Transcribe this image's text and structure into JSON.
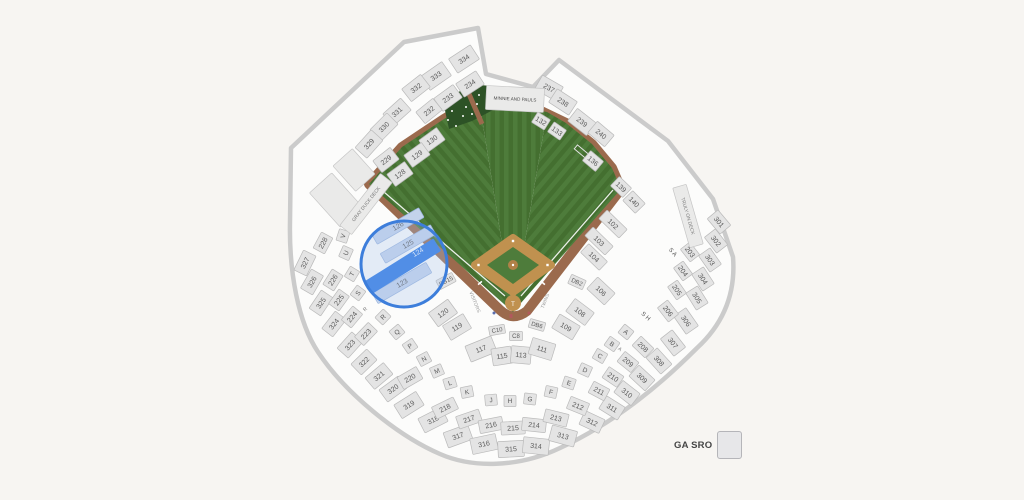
{
  "legend": {
    "label": "GA SRO"
  },
  "map": {
    "highlight": {
      "selected_section": "124",
      "circled_sections": [
        "123",
        "124",
        "125",
        "126"
      ]
    },
    "colors": {
      "background": "#f7f5f2",
      "bowl": "#fcfcfb",
      "wall": "#cbcbcb",
      "section_fill": "#e4e4e4",
      "section_stroke": "#bababa",
      "label": "#5a5a5a",
      "grass_light": "#4e7c3b",
      "grass_dark": "#446f30",
      "track": "#9b6a4d",
      "dirt": "#c0914f",
      "mound": "#b08148",
      "batters_eye": "#2d5226",
      "tint_fill": "#c3d3ec",
      "tint_stroke": "#9ab4dd",
      "selected_fill": "#2b78e4",
      "selected_text": "#eaf2fd",
      "highlight_ring": "#3d7edb",
      "highlight_fill": "#aac4ea"
    },
    "sections": [
      {
        "l": "",
        "x": 336,
        "y": 200,
        "r": -42,
        "w": 30,
        "h": 46,
        "t": "deck"
      },
      {
        "l": "",
        "x": 354,
        "y": 170,
        "r": -42,
        "w": 26,
        "h": 34,
        "t": "deck"
      },
      {
        "l": "334",
        "x": 464,
        "y": 59,
        "r": -33,
        "w": 26,
        "h": 17
      },
      {
        "l": "333",
        "x": 436,
        "y": 76,
        "r": -35,
        "w": 26,
        "h": 17
      },
      {
        "l": "332",
        "x": 416,
        "y": 88,
        "r": -38,
        "w": 24,
        "h": 16
      },
      {
        "l": "331",
        "x": 397,
        "y": 112,
        "r": -42,
        "w": 24,
        "h": 16
      },
      {
        "l": "330",
        "x": 384,
        "y": 127,
        "r": -45,
        "w": 24,
        "h": 16
      },
      {
        "l": "329",
        "x": 369,
        "y": 144,
        "r": -48,
        "w": 24,
        "h": 16
      },
      {
        "l": "327",
        "x": 305,
        "y": 263,
        "r": -64,
        "w": 22,
        "h": 14
      },
      {
        "l": "326",
        "x": 312,
        "y": 282,
        "r": -60,
        "w": 22,
        "h": 14
      },
      {
        "l": "325",
        "x": 321,
        "y": 303,
        "r": -56,
        "w": 22,
        "h": 14
      },
      {
        "l": "324",
        "x": 334,
        "y": 324,
        "r": -52,
        "w": 22,
        "h": 14
      },
      {
        "l": "323",
        "x": 350,
        "y": 345,
        "r": -48,
        "w": 22,
        "h": 15
      },
      {
        "l": "322",
        "x": 364,
        "y": 362,
        "r": -44,
        "w": 22,
        "h": 15
      },
      {
        "l": "321",
        "x": 379,
        "y": 376,
        "r": -40,
        "w": 24,
        "h": 15
      },
      {
        "l": "320",
        "x": 393,
        "y": 389,
        "r": -36,
        "w": 24,
        "h": 15
      },
      {
        "l": "319",
        "x": 409,
        "y": 405,
        "r": -32,
        "w": 26,
        "h": 16
      },
      {
        "l": "318",
        "x": 433,
        "y": 420,
        "r": -27,
        "w": 26,
        "h": 16
      },
      {
        "l": "317",
        "x": 458,
        "y": 436,
        "r": -20,
        "w": 26,
        "h": 16
      },
      {
        "l": "316",
        "x": 484,
        "y": 444,
        "r": -12,
        "w": 26,
        "h": 16
      },
      {
        "l": "315",
        "x": 511,
        "y": 449,
        "r": -3,
        "w": 26,
        "h": 16
      },
      {
        "l": "314",
        "x": 536,
        "y": 446,
        "r": 6,
        "w": 26,
        "h": 16
      },
      {
        "l": "313",
        "x": 563,
        "y": 436,
        "r": 15,
        "w": 26,
        "h": 16
      },
      {
        "l": "312",
        "x": 592,
        "y": 422,
        "r": 25,
        "w": 22,
        "h": 15
      },
      {
        "l": "311",
        "x": 612,
        "y": 408,
        "r": 32,
        "w": 22,
        "h": 15
      },
      {
        "l": "310",
        "x": 627,
        "y": 393,
        "r": 38,
        "w": 22,
        "h": 15
      },
      {
        "l": "309",
        "x": 642,
        "y": 378,
        "r": 43,
        "w": 22,
        "h": 15
      },
      {
        "l": "308",
        "x": 659,
        "y": 361,
        "r": 48,
        "w": 22,
        "h": 15
      },
      {
        "l": "307",
        "x": 673,
        "y": 343,
        "r": 52,
        "w": 22,
        "h": 15
      },
      {
        "l": "306",
        "x": 686,
        "y": 321,
        "r": 55,
        "w": 22,
        "h": 15
      },
      {
        "l": "305",
        "x": 697,
        "y": 298,
        "r": 58,
        "w": 20,
        "h": 14
      },
      {
        "l": "304",
        "x": 703,
        "y": 279,
        "r": 57,
        "w": 20,
        "h": 14
      },
      {
        "l": "303",
        "x": 710,
        "y": 260,
        "r": 55,
        "w": 20,
        "h": 14
      },
      {
        "l": "302",
        "x": 716,
        "y": 241,
        "r": 52,
        "w": 20,
        "h": 14
      },
      {
        "l": "301",
        "x": 719,
        "y": 222,
        "r": 50,
        "w": 20,
        "h": 14
      },
      {
        "l": "234",
        "x": 470,
        "y": 84,
        "r": -33,
        "w": 24,
        "h": 16
      },
      {
        "l": "233",
        "x": 448,
        "y": 98,
        "r": -36,
        "w": 24,
        "h": 16
      },
      {
        "l": "232",
        "x": 429,
        "y": 111,
        "r": -39,
        "w": 22,
        "h": 15
      },
      {
        "l": "229",
        "x": 386,
        "y": 160,
        "r": -38,
        "w": 22,
        "h": 15
      },
      {
        "l": "228",
        "x": 323,
        "y": 243,
        "r": -62,
        "w": 18,
        "h": 13
      },
      {
        "l": "226",
        "x": 333,
        "y": 280,
        "r": -58,
        "w": 18,
        "h": 13
      },
      {
        "l": "225",
        "x": 339,
        "y": 300,
        "r": -54,
        "w": 18,
        "h": 13
      },
      {
        "l": "224",
        "x": 352,
        "y": 317,
        "r": -50,
        "w": 18,
        "h": 13
      },
      {
        "l": "223",
        "x": 366,
        "y": 334,
        "r": -46,
        "w": 20,
        "h": 13
      },
      {
        "l": "220",
        "x": 410,
        "y": 378,
        "r": -30,
        "w": 22,
        "h": 14
      },
      {
        "l": "218",
        "x": 445,
        "y": 408,
        "r": -26,
        "w": 24,
        "h": 13
      },
      {
        "l": "217",
        "x": 469,
        "y": 419,
        "r": -19,
        "w": 24,
        "h": 13
      },
      {
        "l": "216",
        "x": 491,
        "y": 425,
        "r": -11,
        "w": 24,
        "h": 13
      },
      {
        "l": "215",
        "x": 513,
        "y": 428,
        "r": -3,
        "w": 24,
        "h": 13
      },
      {
        "l": "214",
        "x": 534,
        "y": 425,
        "r": 6,
        "w": 24,
        "h": 13
      },
      {
        "l": "213",
        "x": 556,
        "y": 418,
        "r": 14,
        "w": 24,
        "h": 13
      },
      {
        "l": "212",
        "x": 578,
        "y": 406,
        "r": 22,
        "w": 20,
        "h": 13
      },
      {
        "l": "211",
        "x": 599,
        "y": 391,
        "r": 28,
        "w": 18,
        "h": 13
      },
      {
        "l": "210",
        "x": 613,
        "y": 377,
        "r": 34,
        "w": 18,
        "h": 13
      },
      {
        "l": "209",
        "x": 628,
        "y": 362,
        "r": 39,
        "w": 18,
        "h": 13
      },
      {
        "l": "208",
        "x": 643,
        "y": 347,
        "r": 44,
        "w": 18,
        "h": 13
      },
      {
        "l": "206",
        "x": 668,
        "y": 311,
        "r": 52,
        "w": 18,
        "h": 13
      },
      {
        "l": "205",
        "x": 677,
        "y": 290,
        "r": 55,
        "w": 16,
        "h": 12
      },
      {
        "l": "204",
        "x": 683,
        "y": 271,
        "r": 54,
        "w": 16,
        "h": 12
      },
      {
        "l": "203",
        "x": 690,
        "y": 252,
        "r": 52,
        "w": 16,
        "h": 12
      },
      {
        "l": "237",
        "x": 549,
        "y": 88,
        "r": 30,
        "w": 24,
        "h": 16
      },
      {
        "l": "238",
        "x": 563,
        "y": 102,
        "r": 33,
        "w": 24,
        "h": 16
      },
      {
        "l": "239",
        "x": 582,
        "y": 122,
        "r": 38,
        "w": 24,
        "h": 16
      },
      {
        "l": "240",
        "x": 601,
        "y": 134,
        "r": 40,
        "w": 22,
        "h": 15
      },
      {
        "l": "130",
        "x": 432,
        "y": 140,
        "r": -36,
        "w": 22,
        "h": 15
      },
      {
        "l": "129",
        "x": 417,
        "y": 155,
        "r": -36,
        "w": 22,
        "h": 15
      },
      {
        "l": "128",
        "x": 400,
        "y": 174,
        "r": -36,
        "w": 22,
        "h": 15
      },
      {
        "l": "132",
        "x": 541,
        "y": 121,
        "r": 32,
        "w": 15,
        "h": 12
      },
      {
        "l": "133",
        "x": 557,
        "y": 131,
        "r": 35,
        "w": 15,
        "h": 12
      },
      {
        "l": "136",
        "x": 593,
        "y": 161,
        "r": 40,
        "w": 17,
        "h": 13
      },
      {
        "l": "139",
        "x": 621,
        "y": 187,
        "r": 44,
        "w": 17,
        "h": 13
      },
      {
        "l": "140",
        "x": 634,
        "y": 202,
        "r": 46,
        "w": 18,
        "h": 14
      },
      {
        "l": "120",
        "x": 443,
        "y": 313,
        "r": -36,
        "w": 24,
        "h": 17
      },
      {
        "l": "119",
        "x": 457,
        "y": 327,
        "r": -31,
        "w": 24,
        "h": 17
      },
      {
        "l": "117",
        "x": 481,
        "y": 349,
        "r": -22,
        "w": 28,
        "h": 17
      },
      {
        "l": "115",
        "x": 502,
        "y": 356,
        "r": -9,
        "w": 20,
        "h": 17
      },
      {
        "l": "113",
        "x": 521,
        "y": 355,
        "r": 5,
        "w": 20,
        "h": 17
      },
      {
        "l": "111",
        "x": 542,
        "y": 349,
        "r": 17,
        "w": 24,
        "h": 17
      },
      {
        "l": "109",
        "x": 566,
        "y": 327,
        "r": 31,
        "w": 24,
        "h": 16
      },
      {
        "l": "108",
        "x": 580,
        "y": 312,
        "r": 37,
        "w": 24,
        "h": 16
      },
      {
        "l": "106",
        "x": 601,
        "y": 291,
        "r": 43,
        "w": 24,
        "h": 16
      },
      {
        "l": "104",
        "x": 594,
        "y": 257,
        "r": 44,
        "w": 26,
        "h": 12
      },
      {
        "l": "103",
        "x": 599,
        "y": 241,
        "r": 44,
        "w": 28,
        "h": 12
      },
      {
        "l": "102",
        "x": 613,
        "y": 224,
        "r": 44,
        "w": 28,
        "h": 12
      },
      {
        "l": "C10",
        "x": 497,
        "y": 330,
        "r": -10,
        "w": 16,
        "h": 9,
        "fs": 6
      },
      {
        "l": "C8",
        "x": 516,
        "y": 336,
        "r": 0,
        "w": 13,
        "h": 9,
        "fs": 6
      },
      {
        "l": "DB6",
        "x": 537,
        "y": 325,
        "r": 16,
        "w": 16,
        "h": 9,
        "fs": 6
      },
      {
        "l": "DB15",
        "x": 446,
        "y": 281,
        "r": -28,
        "w": 18,
        "h": 10,
        "fs": 6
      },
      {
        "l": "DB2",
        "x": 577,
        "y": 282,
        "r": 24,
        "w": 16,
        "h": 10,
        "fs": 6
      },
      {
        "l": "V",
        "x": 343,
        "y": 236,
        "r": -72,
        "w": 12,
        "h": 11,
        "t": "ltr"
      },
      {
        "l": "U",
        "x": 346,
        "y": 253,
        "r": -66,
        "w": 12,
        "h": 11,
        "t": "ltr"
      },
      {
        "l": "T",
        "x": 352,
        "y": 274,
        "r": -59,
        "w": 12,
        "h": 11,
        "t": "ltr"
      },
      {
        "l": "S",
        "x": 358,
        "y": 293,
        "r": -53,
        "w": 12,
        "h": 11,
        "t": "ltr"
      },
      {
        "l": "R",
        "x": 383,
        "y": 317,
        "r": -46,
        "w": 12,
        "h": 11,
        "t": "ltr"
      },
      {
        "l": "Q",
        "x": 397,
        "y": 332,
        "r": -40,
        "w": 12,
        "h": 11,
        "t": "ltr"
      },
      {
        "l": "P",
        "x": 410,
        "y": 346,
        "r": -34,
        "w": 12,
        "h": 11,
        "t": "ltr"
      },
      {
        "l": "N",
        "x": 424,
        "y": 359,
        "r": -28,
        "w": 12,
        "h": 11,
        "t": "ltr"
      },
      {
        "l": "M",
        "x": 437,
        "y": 371,
        "r": -23,
        "w": 12,
        "h": 11,
        "t": "ltr"
      },
      {
        "l": "L",
        "x": 450,
        "y": 383,
        "r": -17,
        "w": 12,
        "h": 11,
        "t": "ltr"
      },
      {
        "l": "K",
        "x": 467,
        "y": 392,
        "r": -11,
        "w": 12,
        "h": 11,
        "t": "ltr"
      },
      {
        "l": "J",
        "x": 491,
        "y": 400,
        "r": -5,
        "w": 12,
        "h": 11,
        "t": "ltr"
      },
      {
        "l": "H",
        "x": 510,
        "y": 401,
        "r": 0,
        "w": 12,
        "h": 11,
        "t": "ltr"
      },
      {
        "l": "G",
        "x": 530,
        "y": 399,
        "r": 6,
        "w": 12,
        "h": 11,
        "t": "ltr"
      },
      {
        "l": "F",
        "x": 551,
        "y": 392,
        "r": 12,
        "w": 12,
        "h": 11,
        "t": "ltr"
      },
      {
        "l": "E",
        "x": 569,
        "y": 383,
        "r": 18,
        "w": 12,
        "h": 11,
        "t": "ltr"
      },
      {
        "l": "D",
        "x": 585,
        "y": 370,
        "r": 24,
        "w": 12,
        "h": 11,
        "t": "ltr"
      },
      {
        "l": "C",
        "x": 600,
        "y": 356,
        "r": 30,
        "w": 12,
        "h": 11,
        "t": "ltr"
      },
      {
        "l": "B",
        "x": 612,
        "y": 344,
        "r": 35,
        "w": 12,
        "h": 11,
        "t": "ltr"
      },
      {
        "l": "A",
        "x": 626,
        "y": 332,
        "r": 39,
        "w": 12,
        "h": 11,
        "t": "ltr"
      },
      {
        "l": "R",
        "x": 365,
        "y": 309,
        "r": -46,
        "t": "txt",
        "fs": 5,
        "c": "#777777"
      },
      {
        "l": "A",
        "x": 620,
        "y": 349,
        "r": 40,
        "t": "txt",
        "fs": 5,
        "c": "#777777"
      },
      {
        "l": "S A",
        "x": 673,
        "y": 252,
        "r": 48,
        "t": "txt",
        "fs": 6,
        "c": "#555555"
      },
      {
        "l": "S H",
        "x": 646,
        "y": 316,
        "r": 42,
        "t": "txt",
        "fs": 6,
        "c": "#555555"
      },
      {
        "l": "GRAY DUCK DECK",
        "x": 366,
        "y": 204,
        "r": -52,
        "w": 66,
        "h": 15,
        "t": "deck",
        "fs": 4.8
      },
      {
        "l": "TRULY ON DECK",
        "x": 688,
        "y": 216,
        "r": 74,
        "w": 62,
        "h": 14,
        "t": "deck",
        "fs": 4.8
      },
      {
        "l": "MINNIE AND PAULS",
        "x": 515,
        "y": 99,
        "r": 3,
        "w": 58,
        "h": 24,
        "t": "deck",
        "fs": 4.6,
        "c": "#4a4a4a"
      },
      {
        "l": "VISITORS",
        "x": 475,
        "y": 302,
        "r": 68,
        "t": "txt",
        "fs": 4.8,
        "c": "#9a9a9a"
      },
      {
        "l": "TWINS",
        "x": 545,
        "y": 301,
        "r": -68,
        "t": "txt",
        "fs": 4.8,
        "c": "#9a9a9a"
      },
      {
        "l": "126",
        "x": 398,
        "y": 226,
        "r": -30,
        "w": 54,
        "h": 11,
        "t": "tint"
      },
      {
        "l": "125",
        "x": 408,
        "y": 244,
        "r": -30,
        "w": 58,
        "h": 11,
        "t": "tint"
      },
      {
        "l": "123",
        "x": 402,
        "y": 283,
        "r": -30,
        "w": 62,
        "h": 12,
        "t": "tint"
      },
      {
        "l": "124",
        "x": 403,
        "y": 266,
        "r": -32,
        "w": 80,
        "h": 14,
        "t": "sel",
        "lx": 20,
        "ly": -4
      },
      {
        "l": "T",
        "x": 513,
        "y": 304,
        "t": "txt",
        "fs": 6,
        "c": "#ffffff"
      }
    ]
  }
}
